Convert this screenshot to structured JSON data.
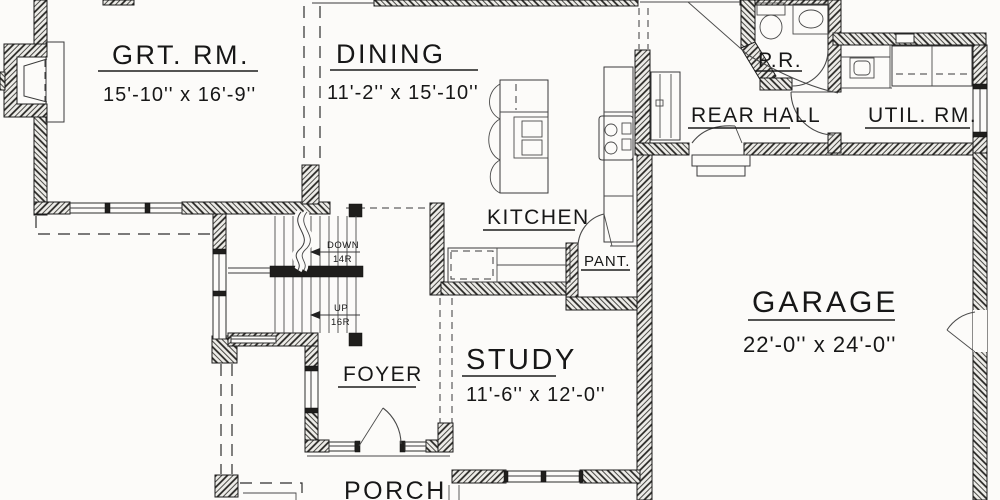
{
  "rooms": {
    "great_room": {
      "name": "GRT. RM.",
      "dims": "15'-10'' x 16'-9''"
    },
    "dining": {
      "name": "DINING",
      "dims": "11'-2'' x 15'-10''"
    },
    "kitchen": {
      "name": "KITCHEN"
    },
    "pantry": {
      "name": "PANT."
    },
    "powder_room": {
      "name": "P.R."
    },
    "rear_hall": {
      "name": "REAR HALL"
    },
    "utility_room": {
      "name": "UTIL. RM."
    },
    "garage": {
      "name": "GARAGE",
      "dims": "22'-0'' x 24'-0''"
    },
    "study": {
      "name": "STUDY",
      "dims": "11'-6'' x 12'-0''"
    },
    "foyer": {
      "name": "FOYER"
    },
    "porch": {
      "name": "PORCH"
    }
  },
  "stairs": {
    "down_label": "DOWN",
    "down_risers": "14R",
    "up_label": "UP",
    "up_risers": "16R"
  },
  "colors": {
    "paper": "#fcfbf9",
    "ink": "#171717",
    "wall_hatch": "#23221f"
  }
}
